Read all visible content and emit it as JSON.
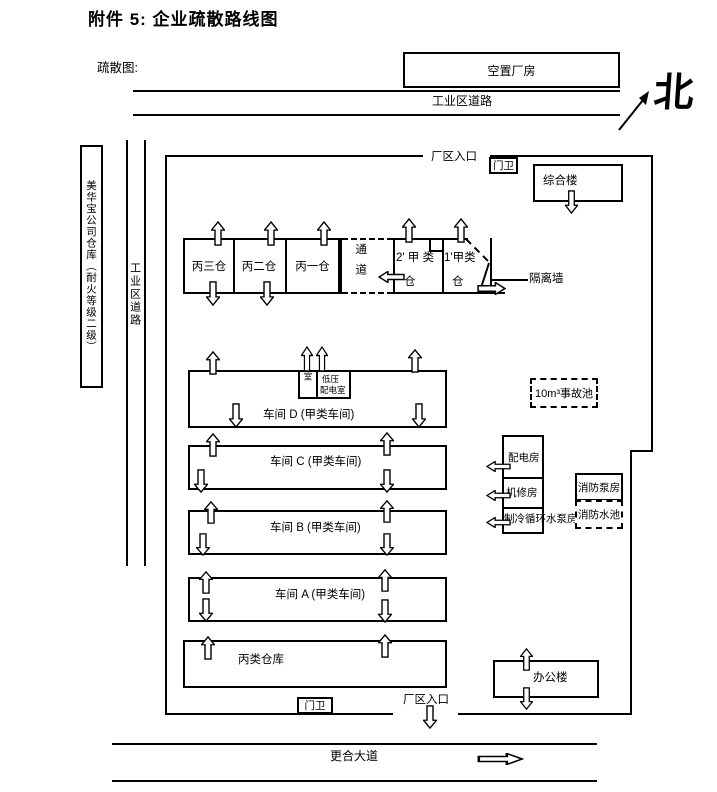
{
  "page": {
    "title": "附件 5: 企业疏散路线图",
    "map_label": "疏散图:"
  },
  "compass": {
    "north": "北"
  },
  "surroundings": {
    "vacant_plant": "空置厂房",
    "industrial_road_top": "工业区道路",
    "neighbor_warehouse": "美华宝公司仓库（耐火等级二级）",
    "industrial_road_left": "工业区道路",
    "avenue": "更合大道"
  },
  "factory": {
    "entrance_top": "厂区入口",
    "gate_top": "门卫",
    "admin_building": "综合楼",
    "warehouse_c3": "丙三仓",
    "warehouse_c2": "丙二仓",
    "warehouse_c1": "丙一仓",
    "passage": "通道",
    "warehouse_a2_line1": "2' 甲 类",
    "warehouse_a2_line2": "仓",
    "warehouse_a1_line1": "1'甲类",
    "warehouse_a1_line2": "仓",
    "isolation_wall": "隔离墙",
    "qc_room": "质检室",
    "lv_room_line1": "低压",
    "lv_room_line2": "配电室",
    "workshop_d": "车间 D (甲类车间)",
    "workshop_c": "车间 C (甲类车间)",
    "workshop_b": "车间 B (甲类车间)",
    "workshop_a": "车间 A (甲类车间)",
    "warehouse_class_c": "丙类仓库",
    "accident_pool": "10m³事故池",
    "power_room": "配电房",
    "repair_room": "机修房",
    "cooling_pump_room": "制冷循环水泵房",
    "fire_pump_room": "消防泵房",
    "fire_pool": "消防水池",
    "office_building": "办公楼",
    "gate_bottom": "门卫",
    "entrance_bottom": "厂区入口"
  }
}
